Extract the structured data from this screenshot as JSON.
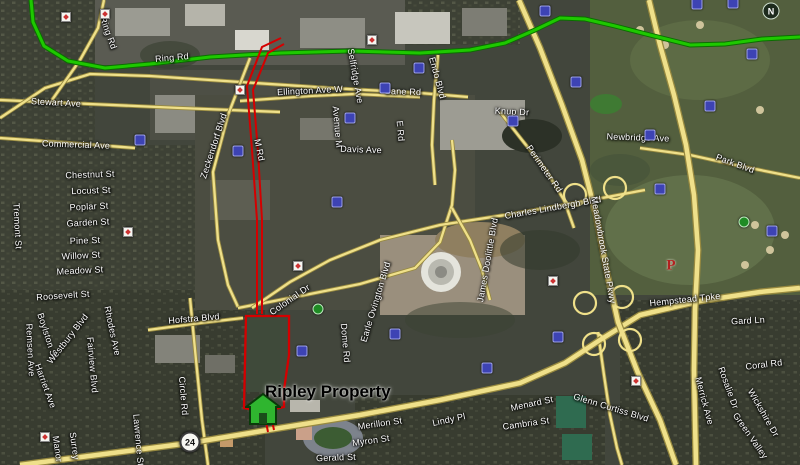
{
  "map": {
    "property_label": "Ripley Property",
    "route_shield": "24",
    "compass_label": "N",
    "parking_label": "P",
    "colors": {
      "route_highlight": "#1ec800",
      "route_casing": "#0b6e00",
      "road_fill": "#efe08a",
      "road_casing": "#97893f",
      "property_outline": "#d40000",
      "label_text": "#ffffff",
      "property_label_color": "#000000"
    },
    "street_labels": [
      {
        "t": "Ring Rd",
        "x": 108,
        "y": 33,
        "r": 70
      },
      {
        "t": "Ring Rd",
        "x": 172,
        "y": 58,
        "r": -5
      },
      {
        "t": "Stewart Ave",
        "x": 56,
        "y": 103,
        "r": 3
      },
      {
        "t": "Commercial Ave",
        "x": 76,
        "y": 145,
        "r": 2
      },
      {
        "t": "Zeckendorf Blvd",
        "x": 214,
        "y": 146,
        "r": -72
      },
      {
        "t": "M Rd",
        "x": 259,
        "y": 150,
        "r": 78
      },
      {
        "t": "Ellington Ave W",
        "x": 310,
        "y": 91,
        "r": -3
      },
      {
        "t": "Selfridge Ave",
        "x": 355,
        "y": 76,
        "r": 80
      },
      {
        "t": "Avenue M",
        "x": 337,
        "y": 127,
        "r": 85
      },
      {
        "t": "Bane Rd",
        "x": 403,
        "y": 92,
        "r": 2
      },
      {
        "t": "Endo Blvd",
        "x": 437,
        "y": 78,
        "r": 75
      },
      {
        "t": "E Rd",
        "x": 400,
        "y": 131,
        "r": 85
      },
      {
        "t": "Davis Ave",
        "x": 361,
        "y": 150,
        "r": 2
      },
      {
        "t": "Knup Dr",
        "x": 512,
        "y": 112,
        "r": 3
      },
      {
        "t": "Newbridge Ave",
        "x": 638,
        "y": 138,
        "r": 2
      },
      {
        "t": "Park Blvd",
        "x": 735,
        "y": 164,
        "r": 20
      },
      {
        "t": "Perimeter Rd",
        "x": 544,
        "y": 169,
        "r": 55
      },
      {
        "t": "Charles Lindbergh Blvd",
        "x": 553,
        "y": 208,
        "r": -10
      },
      {
        "t": "Meadowbrook State Pkwy",
        "x": 603,
        "y": 250,
        "r": 80
      },
      {
        "t": "James Doolittle Blvd",
        "x": 488,
        "y": 260,
        "r": -80
      },
      {
        "t": "Earle Ovington Blvd",
        "x": 376,
        "y": 302,
        "r": -73
      },
      {
        "t": "Dome Rd",
        "x": 345,
        "y": 343,
        "r": 85
      },
      {
        "t": "Colonial Dr",
        "x": 290,
        "y": 300,
        "r": -35
      },
      {
        "t": "Hofstra Blvd",
        "x": 194,
        "y": 319,
        "r": -5
      },
      {
        "t": "Circle Rd",
        "x": 183,
        "y": 396,
        "r": 85
      },
      {
        "t": "Chestnut St",
        "x": 90,
        "y": 175,
        "r": -2
      },
      {
        "t": "Locust St",
        "x": 91,
        "y": 191,
        "r": -2
      },
      {
        "t": "Poplar St",
        "x": 89,
        "y": 207,
        "r": -3
      },
      {
        "t": "Garden St",
        "x": 88,
        "y": 223,
        "r": -3
      },
      {
        "t": "Pine St",
        "x": 85,
        "y": 241,
        "r": -2
      },
      {
        "t": "Willow St",
        "x": 81,
        "y": 256,
        "r": -3
      },
      {
        "t": "Meadow St",
        "x": 80,
        "y": 271,
        "r": -3
      },
      {
        "t": "Tremont St",
        "x": 17,
        "y": 226,
        "r": 87
      },
      {
        "t": "Roosevelt St",
        "x": 63,
        "y": 296,
        "r": -4
      },
      {
        "t": "Remsen Ave",
        "x": 30,
        "y": 350,
        "r": 87
      },
      {
        "t": "Boylston St",
        "x": 47,
        "y": 336,
        "r": 72
      },
      {
        "t": "Westbury Blvd",
        "x": 68,
        "y": 339,
        "r": -52
      },
      {
        "t": "Harriet Ave",
        "x": 45,
        "y": 386,
        "r": 70
      },
      {
        "t": "Fairview Blvd",
        "x": 92,
        "y": 365,
        "r": 85
      },
      {
        "t": "Rhodes Ave",
        "x": 112,
        "y": 331,
        "r": 78
      },
      {
        "t": "Lawrence St",
        "x": 138,
        "y": 440,
        "r": 85
      },
      {
        "t": "Surrey",
        "x": 74,
        "y": 446,
        "r": 82
      },
      {
        "t": "Manor",
        "x": 57,
        "y": 449,
        "r": 82
      },
      {
        "t": "Gerald St",
        "x": 336,
        "y": 458,
        "r": -2
      },
      {
        "t": "Merillon St",
        "x": 380,
        "y": 424,
        "r": -8
      },
      {
        "t": "Myron St",
        "x": 371,
        "y": 441,
        "r": -8
      },
      {
        "t": "Lindy Pl",
        "x": 449,
        "y": 420,
        "r": -12
      },
      {
        "t": "Menard St",
        "x": 532,
        "y": 404,
        "r": -12
      },
      {
        "t": "Cambria St",
        "x": 526,
        "y": 424,
        "r": -8
      },
      {
        "t": "Glenn Curtiss Blvd",
        "x": 611,
        "y": 408,
        "r": 17
      },
      {
        "t": "Hempstead Tpke",
        "x": 685,
        "y": 300,
        "r": -6
      },
      {
        "t": "Gard Ln",
        "x": 748,
        "y": 321,
        "r": -3
      },
      {
        "t": "Rosalie Dr",
        "x": 728,
        "y": 388,
        "r": 70
      },
      {
        "t": "Coral Rd",
        "x": 764,
        "y": 365,
        "r": -7
      },
      {
        "t": "Wickshire Dr",
        "x": 763,
        "y": 413,
        "r": 60
      },
      {
        "t": "Green Valley",
        "x": 750,
        "y": 436,
        "r": 55
      },
      {
        "t": "Merrick Ave",
        "x": 704,
        "y": 401,
        "r": 75
      }
    ],
    "pois": [
      {
        "x": 140,
        "y": 140,
        "k": "b"
      },
      {
        "x": 238,
        "y": 151,
        "k": "b"
      },
      {
        "x": 337,
        "y": 202,
        "k": "b"
      },
      {
        "x": 385,
        "y": 88,
        "k": "b"
      },
      {
        "x": 419,
        "y": 68,
        "k": "b"
      },
      {
        "x": 350,
        "y": 118,
        "k": "b"
      },
      {
        "x": 513,
        "y": 121,
        "k": "b"
      },
      {
        "x": 545,
        "y": 11,
        "k": "b"
      },
      {
        "x": 576,
        "y": 82,
        "k": "b"
      },
      {
        "x": 650,
        "y": 135,
        "k": "b"
      },
      {
        "x": 710,
        "y": 106,
        "k": "b"
      },
      {
        "x": 752,
        "y": 54,
        "k": "b"
      },
      {
        "x": 697,
        "y": 4,
        "k": "b"
      },
      {
        "x": 733,
        "y": 3,
        "k": "b"
      },
      {
        "x": 395,
        "y": 334,
        "k": "b"
      },
      {
        "x": 487,
        "y": 368,
        "k": "b"
      },
      {
        "x": 558,
        "y": 337,
        "k": "b"
      },
      {
        "x": 660,
        "y": 189,
        "k": "b"
      },
      {
        "x": 772,
        "y": 231,
        "k": "b"
      },
      {
        "x": 302,
        "y": 351,
        "k": "b"
      },
      {
        "x": 240,
        "y": 90,
        "k": "s"
      },
      {
        "x": 298,
        "y": 266,
        "k": "s"
      },
      {
        "x": 128,
        "y": 232,
        "k": "s"
      },
      {
        "x": 553,
        "y": 281,
        "k": "s"
      },
      {
        "x": 636,
        "y": 381,
        "k": "s"
      },
      {
        "x": 66,
        "y": 17,
        "k": "s"
      },
      {
        "x": 105,
        "y": 14,
        "k": "s"
      },
      {
        "x": 45,
        "y": 437,
        "k": "s"
      },
      {
        "x": 372,
        "y": 40,
        "k": "s"
      },
      {
        "x": 318,
        "y": 309,
        "k": "g"
      },
      {
        "x": 744,
        "y": 222,
        "k": "g"
      }
    ],
    "roads": {
      "green": [
        [
          31,
          0
        ],
        [
          33,
          22
        ],
        [
          44,
          46
        ],
        [
          68,
          61
        ],
        [
          105,
          68
        ],
        [
          150,
          64
        ],
        [
          210,
          57
        ],
        [
          280,
          53
        ],
        [
          350,
          51
        ],
        [
          420,
          53
        ],
        [
          470,
          50
        ],
        [
          505,
          43
        ],
        [
          535,
          30
        ],
        [
          560,
          18
        ],
        [
          585,
          19
        ],
        [
          615,
          26
        ],
        [
          650,
          35
        ],
        [
          690,
          45
        ],
        [
          725,
          44
        ],
        [
          762,
          39
        ],
        [
          800,
          37
        ]
      ],
      "major": [
        [
          [
            20,
            465
          ],
          [
            120,
            452
          ],
          [
            190,
            443
          ],
          [
            280,
            428
          ],
          [
            360,
            415
          ],
          [
            440,
            400
          ],
          [
            520,
            383
          ],
          [
            565,
            363
          ],
          [
            600,
            340
          ],
          [
            640,
            315
          ],
          [
            700,
            301
          ],
          [
            760,
            292
          ],
          [
            800,
            288
          ]
        ],
        [
          [
            519,
            0
          ],
          [
            540,
            48
          ],
          [
            562,
            105
          ],
          [
            582,
            160
          ],
          [
            596,
            215
          ],
          [
            606,
            268
          ],
          [
            618,
            322
          ],
          [
            638,
            373
          ],
          [
            660,
            420
          ],
          [
            676,
            465
          ]
        ],
        [
          [
            649,
            0
          ],
          [
            660,
            45
          ],
          [
            674,
            95
          ],
          [
            686,
            145
          ],
          [
            694,
            195
          ],
          [
            698,
            250
          ],
          [
            695,
            310
          ],
          [
            694,
            370
          ],
          [
            695,
            420
          ],
          [
            696,
            465
          ]
        ]
      ],
      "minor": [
        [
          [
            640,
            148
          ],
          [
            690,
            155
          ],
          [
            740,
            166
          ],
          [
            800,
            178
          ]
        ],
        [
          [
            598,
            332
          ],
          [
            604,
            375
          ],
          [
            610,
            415
          ],
          [
            617,
            448
          ],
          [
            622,
            465
          ]
        ],
        [
          [
            0,
            100
          ],
          [
            90,
            104
          ],
          [
            180,
            108
          ],
          [
            280,
            112
          ]
        ],
        [
          [
            0,
            138
          ],
          [
            70,
            143
          ],
          [
            135,
            148
          ]
        ],
        [
          [
            0,
            118
          ],
          [
            45,
            88
          ],
          [
            90,
            74
          ],
          [
            150,
            76
          ],
          [
            240,
            82
          ],
          [
            330,
            88
          ],
          [
            420,
            93
          ],
          [
            468,
            97
          ]
        ],
        [
          [
            52,
            100
          ],
          [
            80,
            60
          ],
          [
            98,
            28
          ],
          [
            104,
            0
          ]
        ],
        [
          [
            250,
            58
          ],
          [
            228,
            115
          ],
          [
            213,
            172
          ],
          [
            218,
            240
          ],
          [
            228,
            285
          ],
          [
            238,
            307
          ]
        ],
        [
          [
            240,
            101
          ],
          [
            310,
            96
          ],
          [
            355,
            94
          ],
          [
            420,
            97
          ]
        ],
        [
          [
            438,
            55
          ],
          [
            434,
            100
          ],
          [
            432,
            145
          ],
          [
            435,
            185
          ]
        ],
        [
          [
            190,
            298
          ],
          [
            196,
            360
          ],
          [
            202,
            420
          ],
          [
            208,
            465
          ]
        ],
        [
          [
            148,
            330
          ],
          [
            200,
            323
          ],
          [
            243,
            318
          ]
        ],
        [
          [
            238,
            308
          ],
          [
            300,
            296
          ],
          [
            360,
            284
          ],
          [
            415,
            268
          ],
          [
            440,
            242
          ],
          [
            452,
            205
          ],
          [
            455,
            170
          ],
          [
            452,
            140
          ]
        ],
        [
          [
            645,
            190
          ],
          [
            575,
            203
          ],
          [
            505,
            215
          ],
          [
            440,
            225
          ],
          [
            380,
            240
          ],
          [
            330,
            260
          ],
          [
            290,
            282
          ],
          [
            252,
            308
          ]
        ],
        [
          [
            500,
            112
          ],
          [
            522,
            140
          ],
          [
            546,
            170
          ],
          [
            564,
            200
          ],
          [
            574,
            228
          ]
        ],
        [
          [
            452,
            208
          ],
          [
            470,
            240
          ],
          [
            482,
            270
          ],
          [
            490,
            300
          ]
        ]
      ],
      "loops": [
        [
          585,
          303
        ],
        [
          622,
          297
        ],
        [
          594,
          344
        ],
        [
          630,
          340
        ],
        [
          575,
          195
        ],
        [
          615,
          188
        ]
      ]
    },
    "outline": {
      "lines": [
        [
          [
            281,
            38
          ],
          [
            262,
            47
          ],
          [
            247,
            86
          ],
          [
            252,
            150
          ],
          [
            257,
            220
          ],
          [
            257,
            314
          ]
        ],
        [
          [
            284,
            44
          ],
          [
            268,
            53
          ],
          [
            253,
            90
          ],
          [
            258,
            152
          ],
          [
            262,
            220
          ],
          [
            262,
            314
          ]
        ],
        [
          [
            264,
            412
          ],
          [
            268,
            432
          ]
        ],
        [
          [
            270,
            411
          ],
          [
            274,
            430
          ]
        ]
      ],
      "polygon": [
        [
          246,
          316
        ],
        [
          289,
          316
        ],
        [
          289,
          355
        ],
        [
          284,
          390
        ],
        [
          284,
          407
        ],
        [
          262,
          412
        ],
        [
          244,
          408
        ]
      ]
    }
  }
}
